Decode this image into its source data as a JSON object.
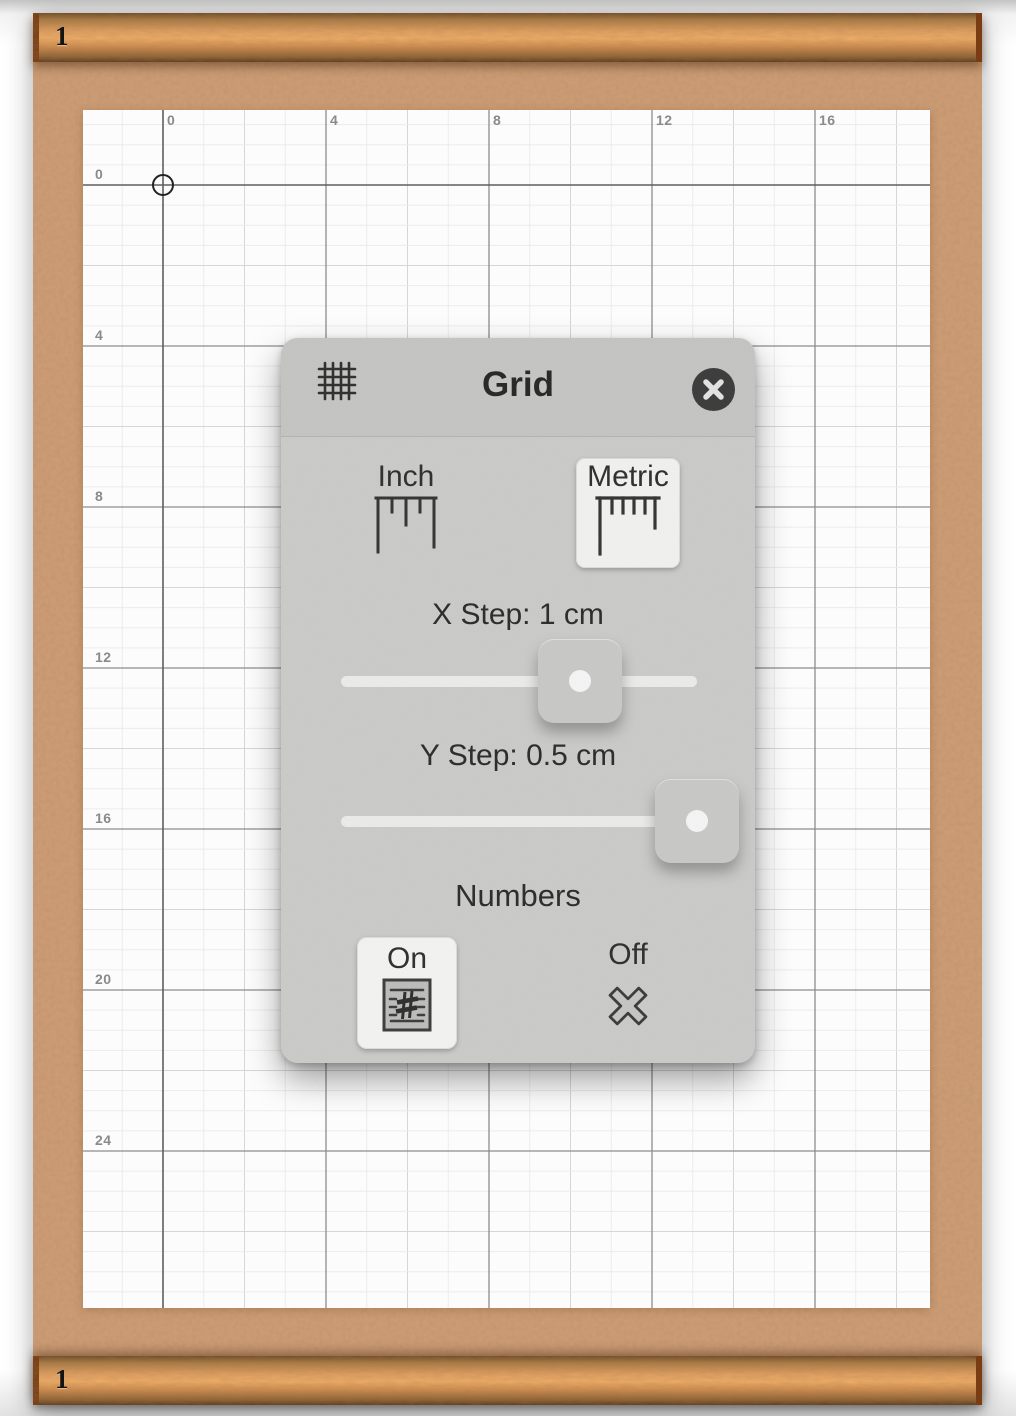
{
  "window": {
    "top_bar_label": "1",
    "bottom_bar_label": "1"
  },
  "graph_paper": {
    "x_axis_labels": [
      "0",
      "4",
      "8",
      "12",
      "16"
    ],
    "y_axis_labels": [
      "0",
      "4",
      "8",
      "12",
      "16",
      "20",
      "24"
    ]
  },
  "dialog": {
    "title": "Grid",
    "units": {
      "options": [
        {
          "label": "Inch",
          "icon": "inch-ruler-icon",
          "selected": false
        },
        {
          "label": "Metric",
          "icon": "metric-ruler-icon",
          "selected": true
        }
      ]
    },
    "x_step": {
      "label": "X Step: 1 cm",
      "value_percent": 67
    },
    "y_step": {
      "label": "Y Step: 0.5 cm",
      "value_percent": 100
    },
    "numbers": {
      "heading": "Numbers",
      "options": [
        {
          "label": "On",
          "icon": "numbers-on-icon",
          "selected": true
        },
        {
          "label": "Off",
          "icon": "cross-icon",
          "selected": false
        }
      ]
    }
  },
  "colors": {
    "cork": "#cf9d76",
    "wood_highlight": "#f1ae67",
    "dialog_gray": "#cbcbc9",
    "selected_option_bg": "#f2f2f0",
    "close_button_bg": "#3b3b3b",
    "grid_major_line": "#8c8c8c",
    "grid_minor_line": "#ebebeb"
  }
}
